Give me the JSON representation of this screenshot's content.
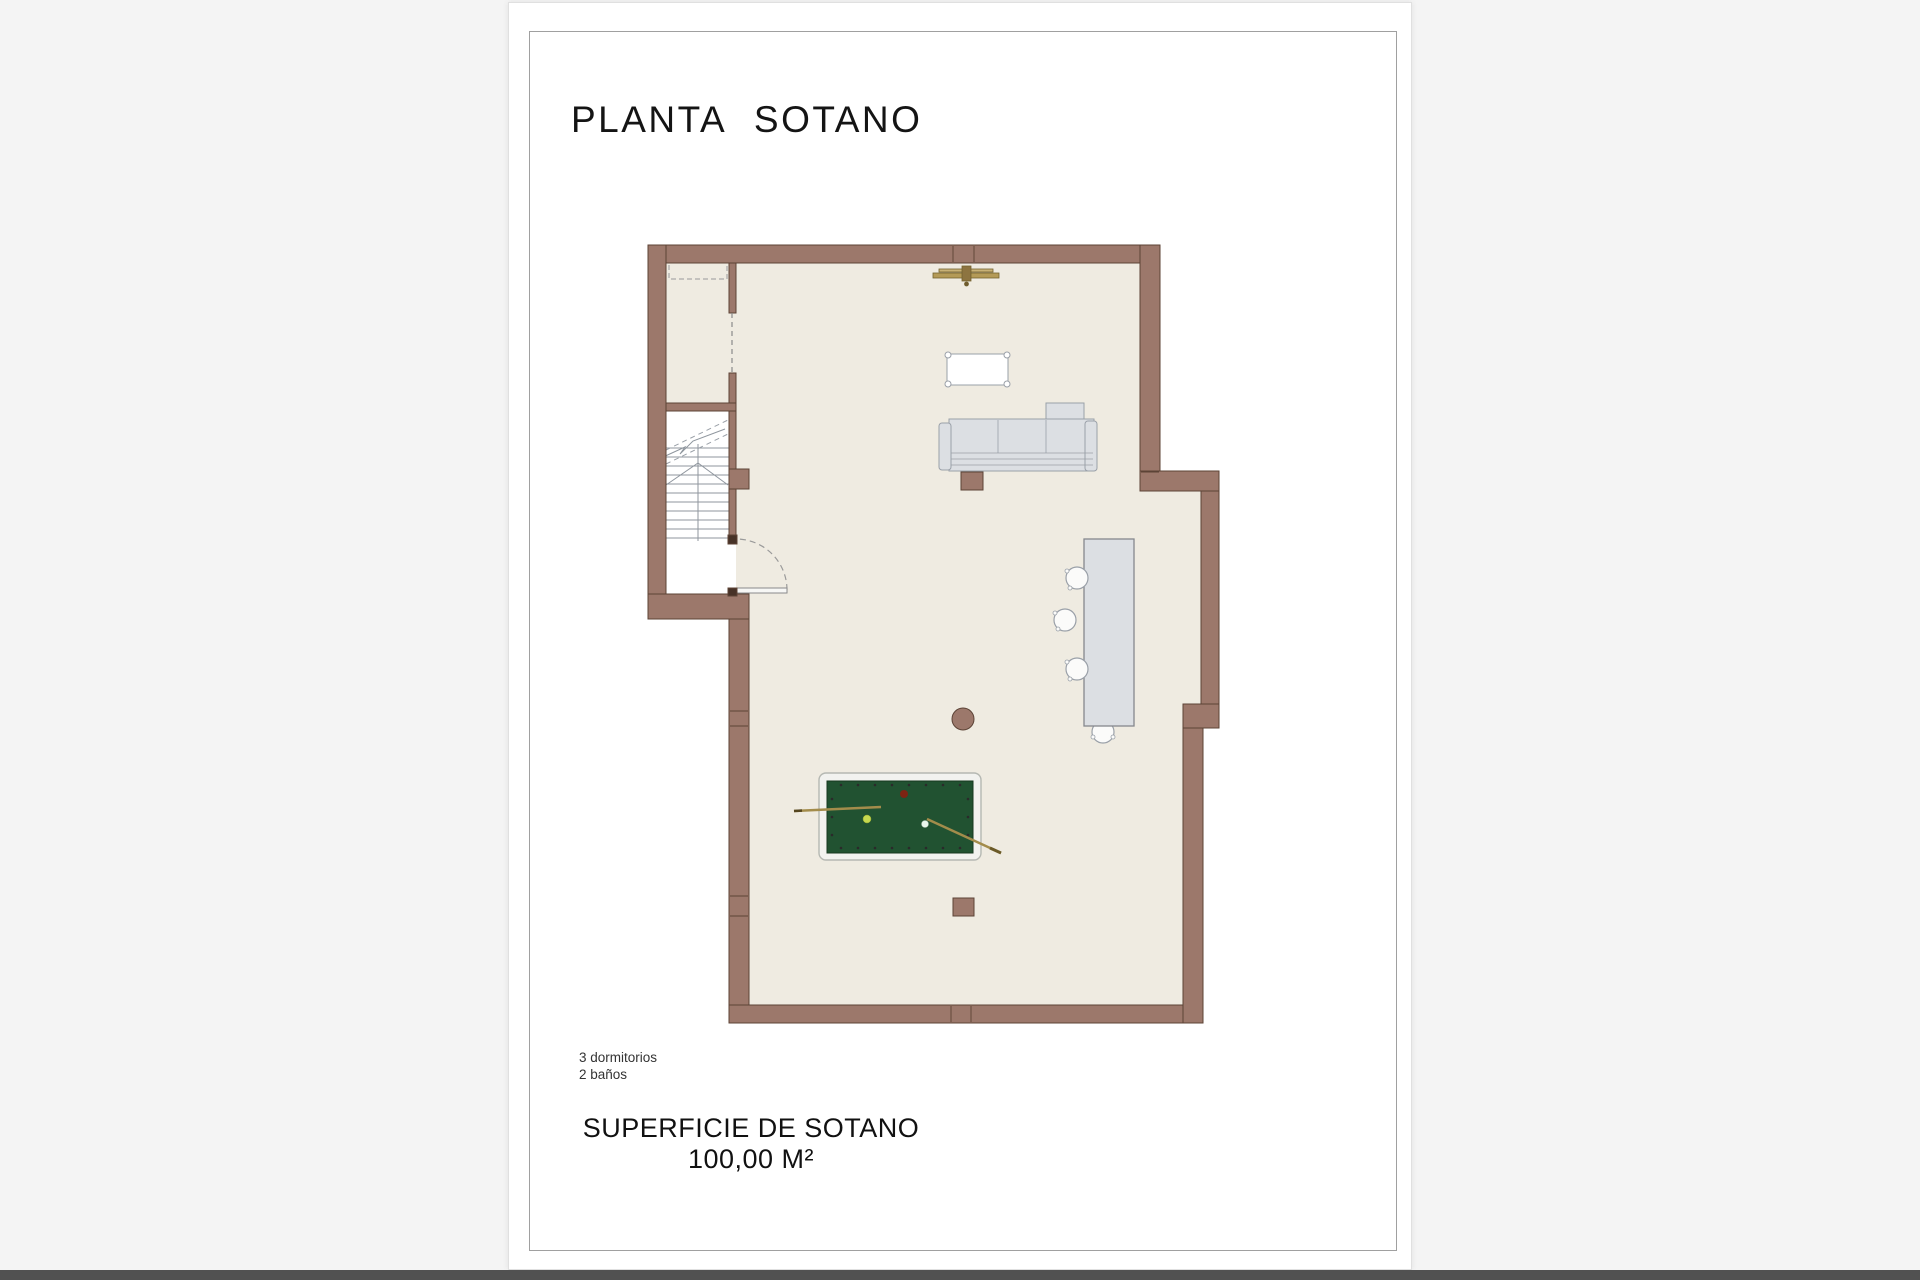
{
  "document": {
    "title": "PLANTA SOTANO",
    "notes": {
      "bedrooms": "3 dormitorios",
      "bathrooms": "2 baños"
    },
    "area": {
      "label": "SUPERFICIE DE SOTANO",
      "value": "100,00 M²"
    }
  },
  "plan": {
    "colors": {
      "wall": "#9c786b",
      "wall_outline": "#5c4336",
      "floor": "#efebe1",
      "stairwell_floor": "#ffffff",
      "furniture_fill": "#dcdfe3",
      "furniture_outline": "#949ba3",
      "pool_felt": "#215231",
      "pool_frame": "#f2f2ef",
      "wood_accent": "#b49a57",
      "ball_red": "#7d2413",
      "ball_yellow": "#c6d94f",
      "ball_white": "#e9f6ec"
    },
    "objects": [
      {
        "name": "staircase",
        "count": 1
      },
      {
        "name": "entry-door-swing",
        "count": 1
      },
      {
        "name": "closet-dashed-outline",
        "count": 1
      },
      {
        "name": "wall-light-fixture",
        "count": 1
      },
      {
        "name": "coffee-table",
        "count": 1
      },
      {
        "name": "sectional-sofa",
        "count": 1
      },
      {
        "name": "sofa-side-table",
        "count": 1
      },
      {
        "name": "kitchen-island",
        "count": 1
      },
      {
        "name": "bar-stool",
        "count": 4
      },
      {
        "name": "round-side-table",
        "count": 1
      },
      {
        "name": "pool-table",
        "count": 1
      },
      {
        "name": "pool-cue",
        "count": 2
      },
      {
        "name": "pool-ball",
        "count": 3
      },
      {
        "name": "storage-cube",
        "count": 1
      }
    ]
  }
}
